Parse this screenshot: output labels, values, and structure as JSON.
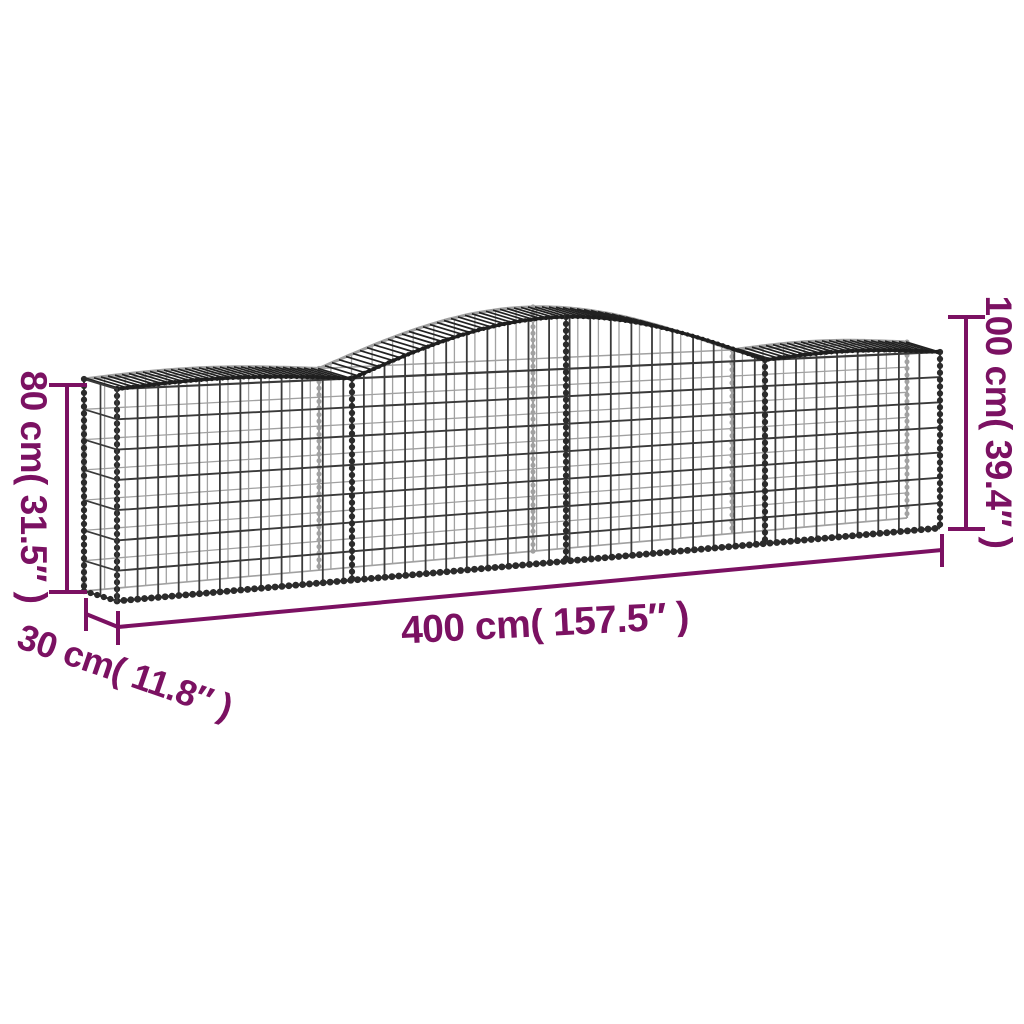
{
  "illustration": {
    "alt": "arched gabion wire mesh basket, wireframe drawing with four sections and raised middle arch"
  },
  "dimensions": {
    "height_end": {
      "text": "80 cm( 31.5″ )"
    },
    "height_arch": {
      "text": "100 cm( 39.4″ )"
    },
    "length": {
      "text": "400 cm( 157.5″ )"
    },
    "depth": {
      "text": "30 cm( 11.8″ )"
    }
  },
  "colors": {
    "accent": "#7B1162",
    "wire_dark": "#2b2b2b",
    "wire_mid": "#3a3a3a",
    "wire_back": "#555555",
    "background": "#ffffff"
  }
}
